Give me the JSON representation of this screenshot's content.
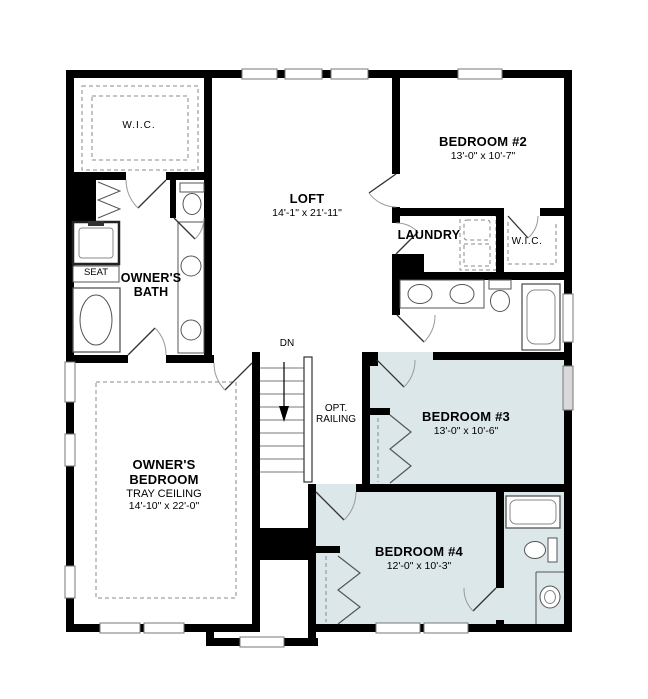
{
  "plan": {
    "type": "floor-plan",
    "colors": {
      "wall": "#000000",
      "bedroom_highlight": "#dce7ea",
      "fixture_line": "#555555",
      "dashed_line": "#8a8a8a",
      "window_shade": "#d9d9d9",
      "background": "#ffffff",
      "text": "#000000"
    },
    "rooms": {
      "wic1": {
        "name": "W.I.C."
      },
      "loft": {
        "name": "LOFT",
        "dims": "14'-1\" x 21'-11\""
      },
      "bedroom2": {
        "name": "BEDROOM #2",
        "dims": "13'-0\" x 10'-7\""
      },
      "laundry": {
        "name": "LAUNDRY"
      },
      "wic2": {
        "name": "W.I.C."
      },
      "owners_bath": {
        "name": "OWNER'S BATH"
      },
      "bedroom3": {
        "name": "BEDROOM #3",
        "dims": "13'-0\" x 10'-6\""
      },
      "bedroom4": {
        "name": "BEDROOM #4",
        "dims": "12'-0\" x 10'-3\""
      },
      "owners_bedroom": {
        "name": "OWNER'S BEDROOM",
        "feature": "TRAY CEILING",
        "dims": "14'-10\" x 22'-0\""
      }
    },
    "annotations": {
      "seat": "SEAT",
      "stairs_direction": "DN",
      "railing": "OPT. RAILING"
    },
    "fixtures": [
      "shower",
      "shower-seat",
      "bathtub",
      "toilet",
      "vanity-sink",
      "washer-dryer",
      "stairs",
      "railing",
      "closet-bifold-doors",
      "door-swing",
      "window",
      "bay-window"
    ]
  }
}
